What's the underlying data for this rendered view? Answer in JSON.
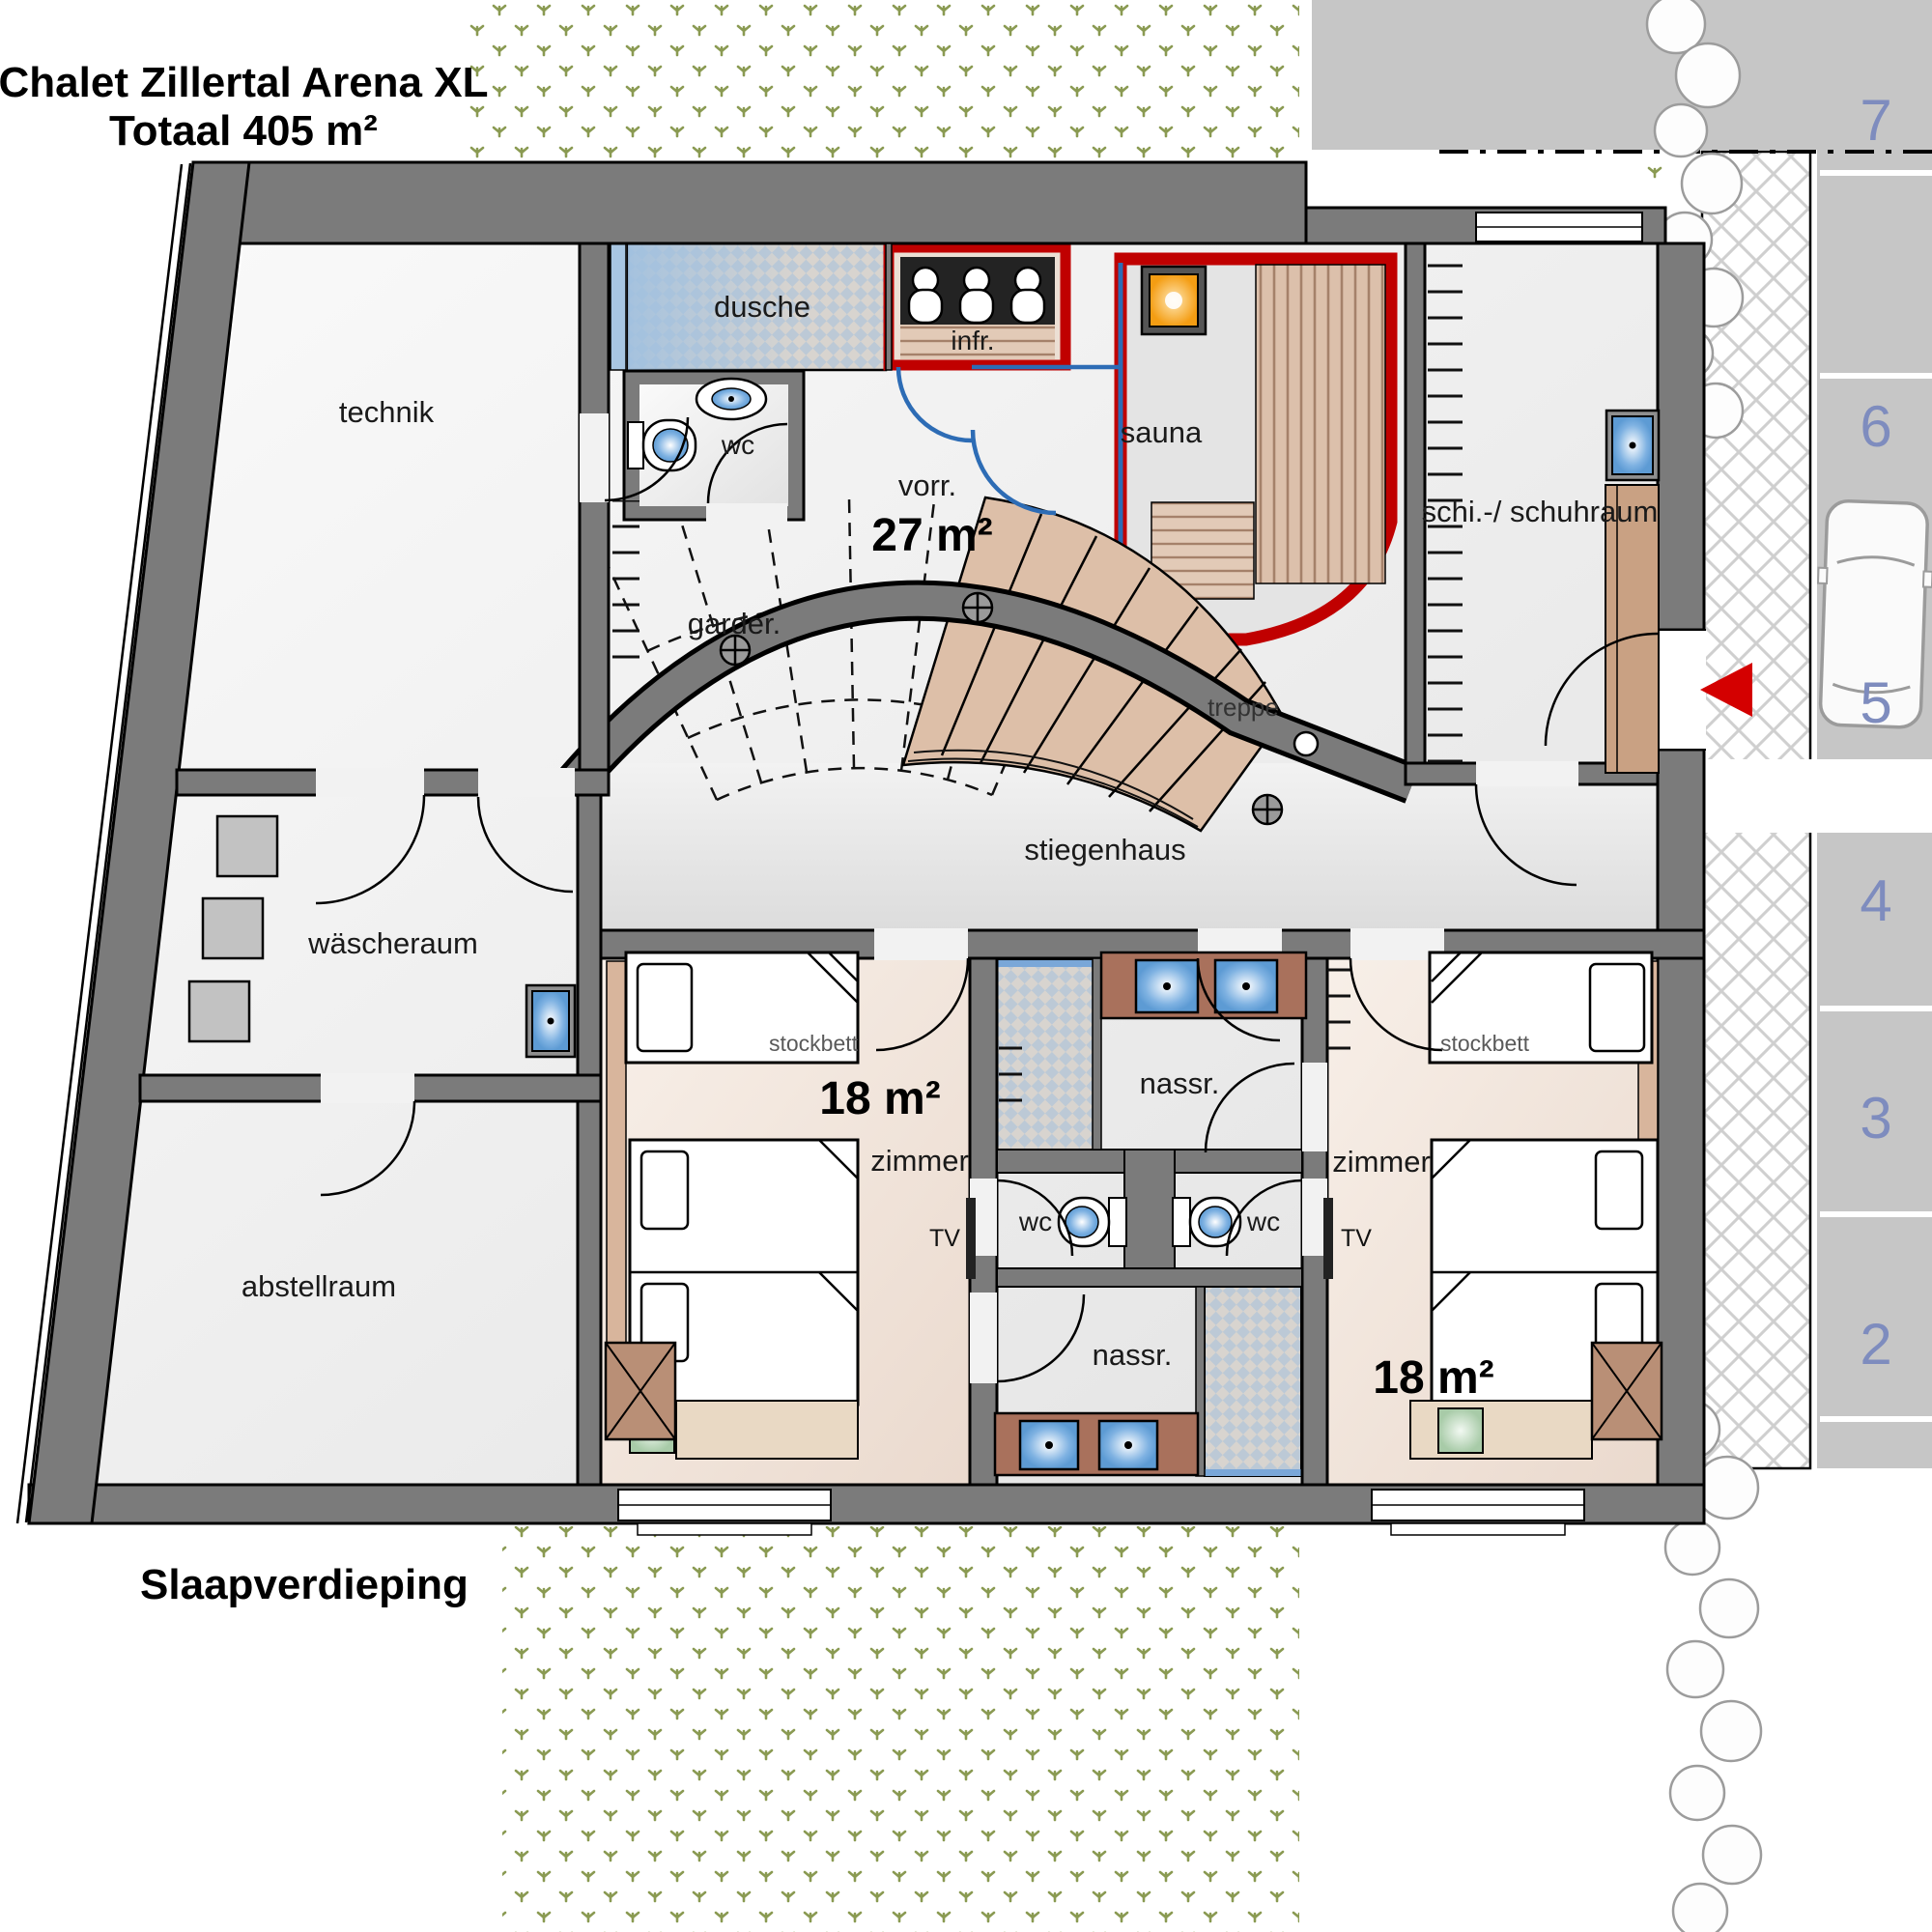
{
  "title": {
    "line1": "Chalet Zillertal Arena XL",
    "line2": "Totaal 405 m²"
  },
  "floor_label": "Slaapverdieping",
  "rooms": {
    "technik": "technik",
    "dusche": "dusche",
    "wc_top": "wc",
    "infrared": "infr.",
    "vorraum": "vorr.",
    "vorraum_area": "27 m²",
    "garderobe": "garder.",
    "sauna": "sauna",
    "ski_schuhraum": "schi.-/ schuhraum",
    "treppe": "treppe",
    "stiegenhaus": "stiegenhaus",
    "waescheraum": "wäscheraum",
    "abstellraum": "abstellraum",
    "nassraum_top": "nassr.",
    "nassraum_bottom": "nassr.",
    "wc_mid_left": "wc",
    "wc_mid_right": "wc",
    "zimmer_left": {
      "name": "zimmer",
      "area": "18 m²",
      "bunk": "stockbett",
      "tv": "TV"
    },
    "zimmer_right": {
      "name": "zimmer",
      "area": "18 m²",
      "bunk": "stockbett",
      "tv": "TV"
    }
  },
  "parking": {
    "spaces": [
      "7",
      "6",
      "5",
      "4",
      "3",
      "2"
    ]
  },
  "colors": {
    "wall": "#7b7b7b",
    "sauna_red": "#c00000",
    "arrow_red": "#d40000",
    "wood": "#dcc0ab",
    "counter": "#a9715c",
    "sink_blue": "#7fb2e2",
    "grass_green": "#8a9a52",
    "parking_number": "#7e8cbe",
    "parking_bg": "#c6c6c6"
  }
}
